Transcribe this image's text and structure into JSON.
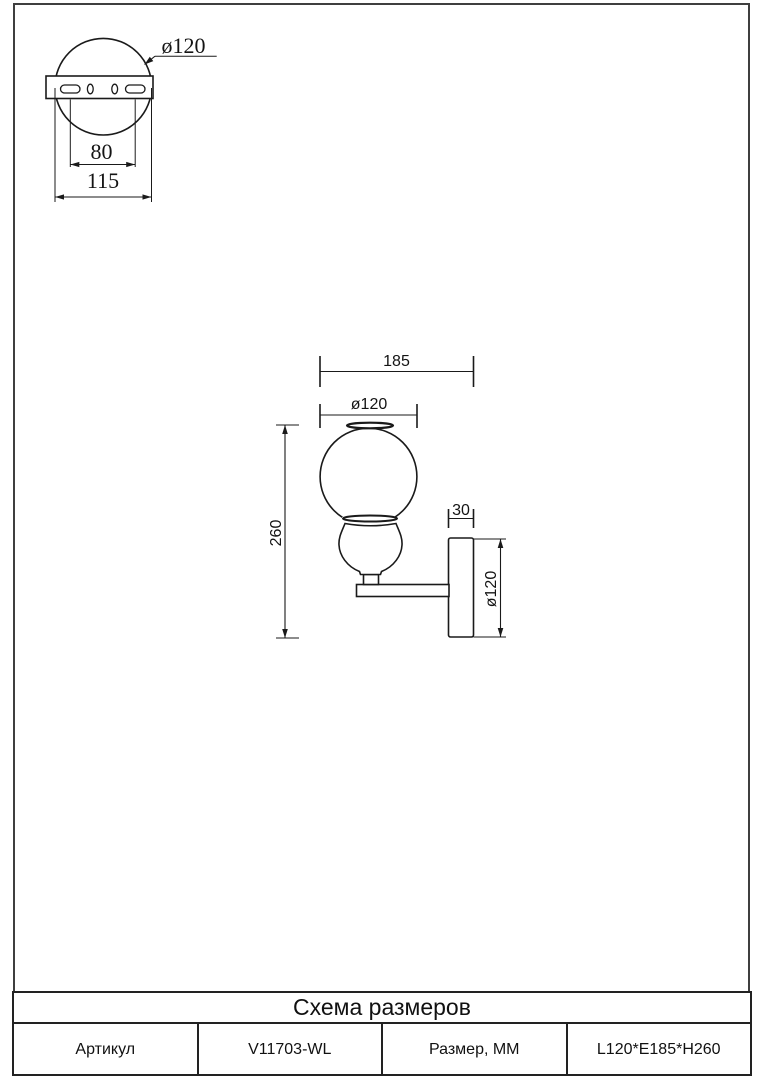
{
  "sheet": {
    "detail_view": {
      "diameter_label": "ø120",
      "hole_spacing_label": "80",
      "width_label": "115"
    },
    "main_view": {
      "depth_label": "185",
      "globe_diameter_label": "ø120",
      "plate_thickness_label": "30",
      "height_label": "260",
      "plate_diameter_label": "ø120"
    },
    "title_block": {
      "title": "Схема размеров",
      "article_label": "Артикул",
      "article_value": "V11703-WL",
      "size_label": "Размер, ММ",
      "size_value": "L120*E185*H260"
    }
  }
}
